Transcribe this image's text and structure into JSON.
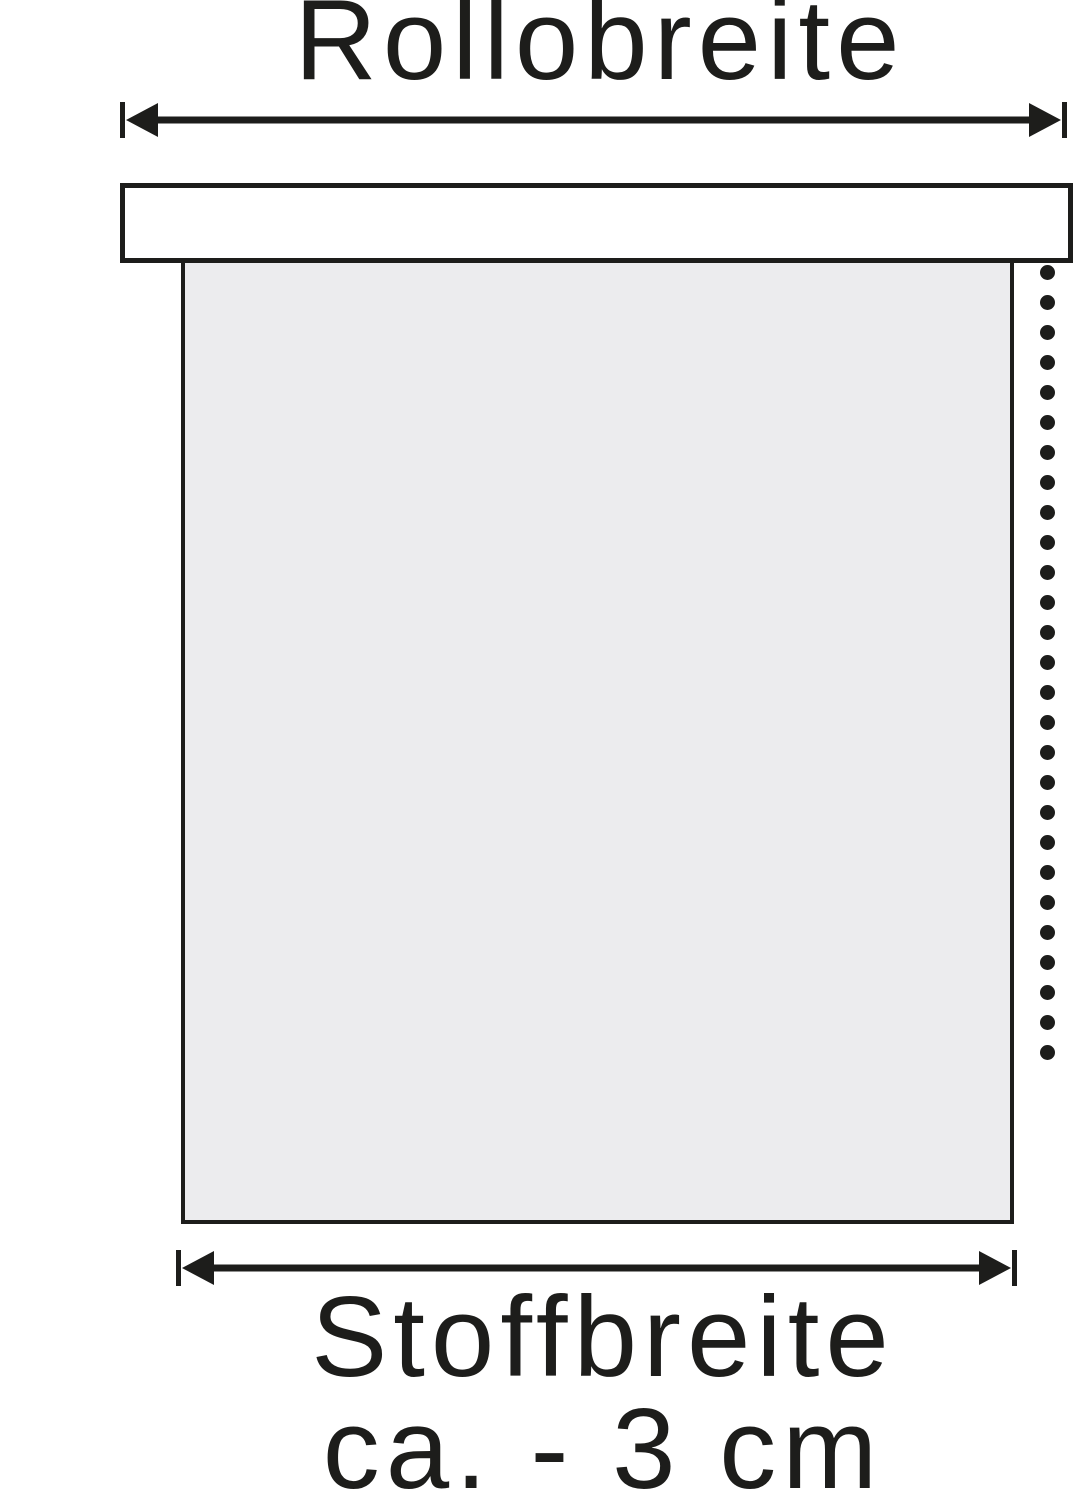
{
  "diagram": {
    "title": "Rollobreite",
    "fabric_width_label_line1": "Stoffbreite",
    "fabric_width_label_line2": "ca. - 3 cm"
  },
  "colors": {
    "line": "#1d1d1b",
    "cassette_fill": "#ffffff",
    "fabric_fill": "#ececee",
    "background": "#ffffff"
  },
  "chain": {
    "dot_count": 27
  }
}
